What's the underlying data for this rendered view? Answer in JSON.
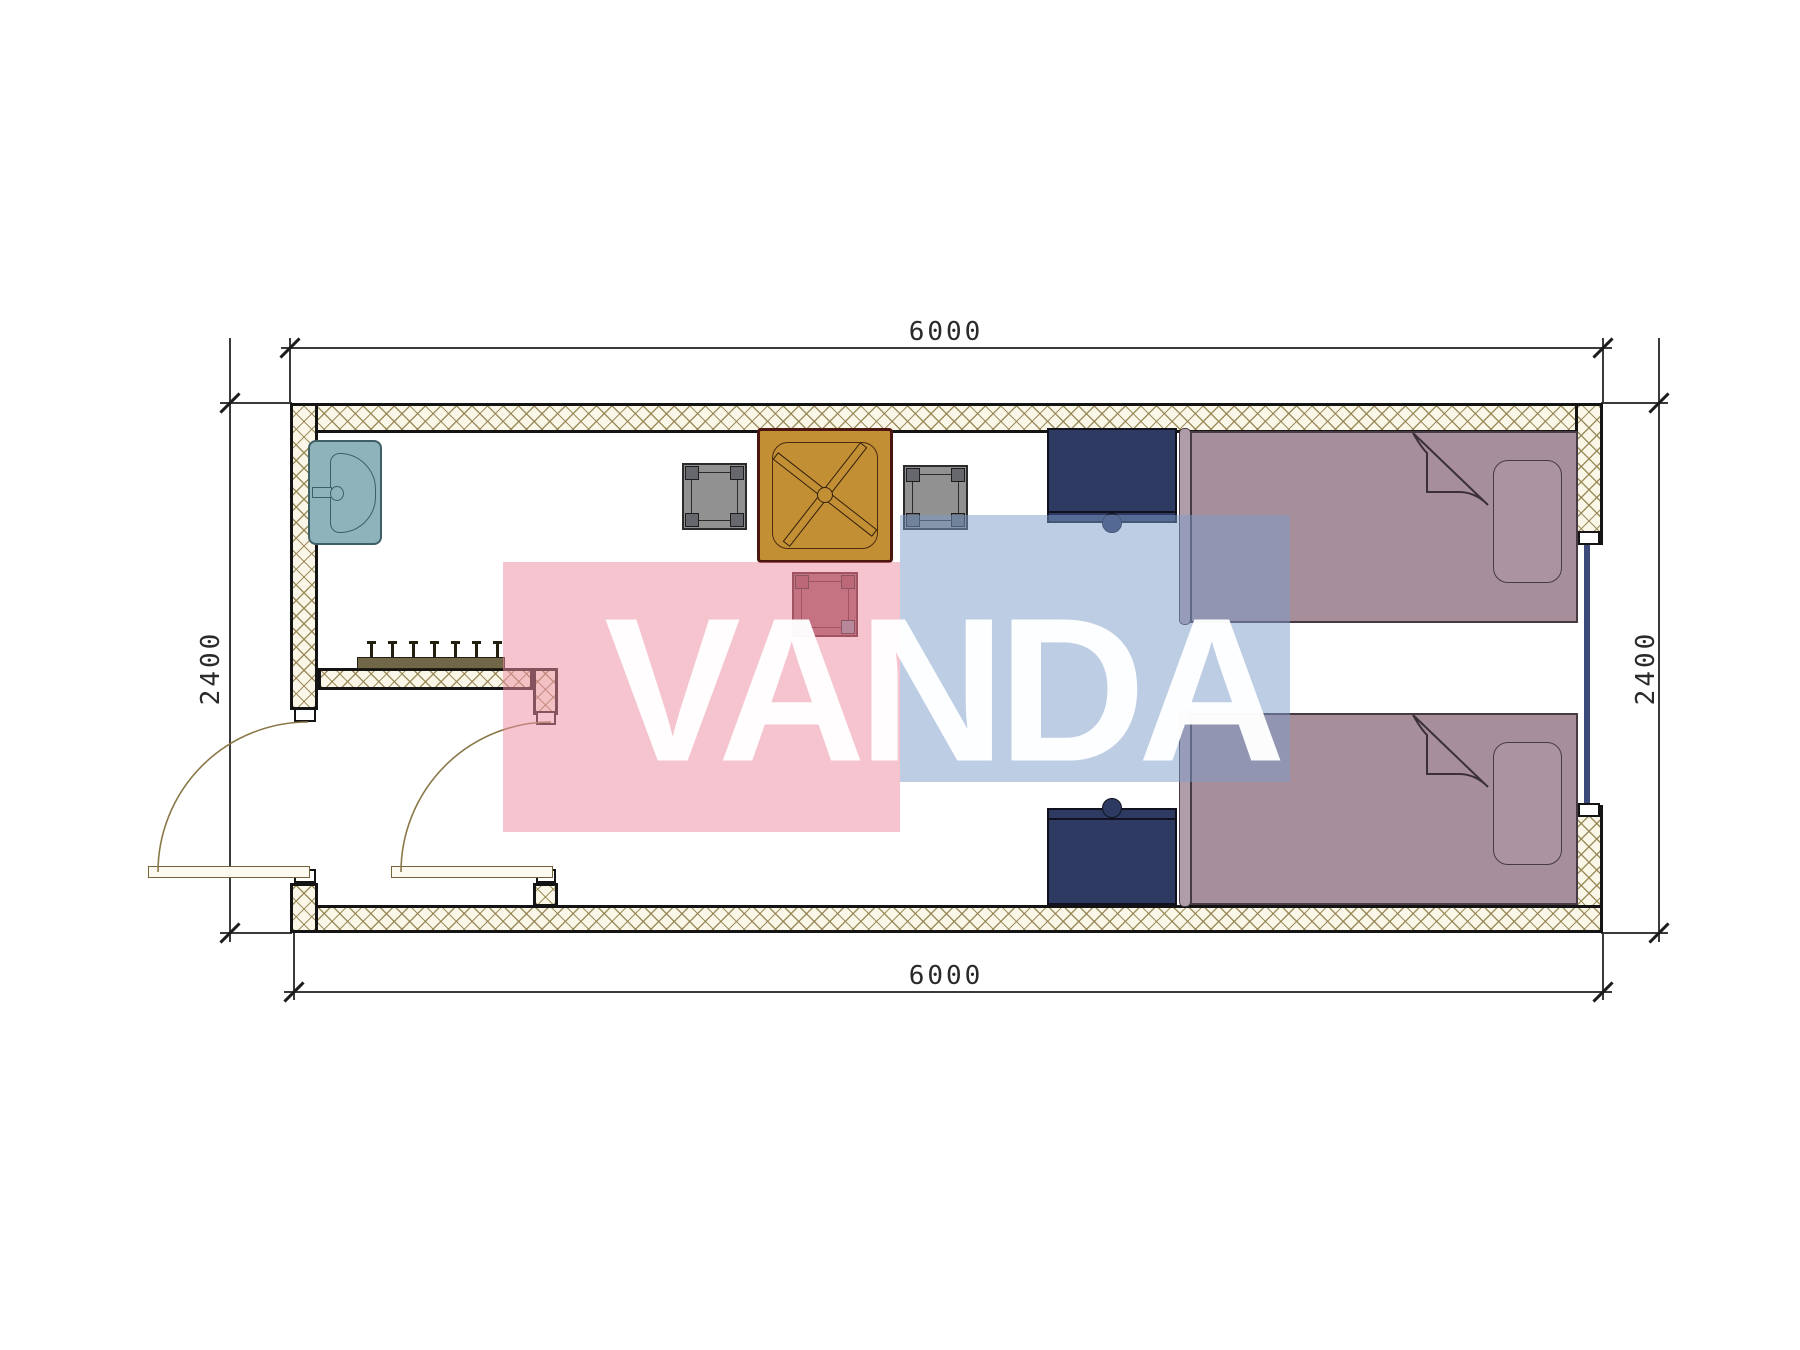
{
  "plan": {
    "type": "architectural floor plan",
    "unit": "mm",
    "room_width_mm": 6000,
    "room_depth_mm": 2400
  },
  "dimensions": {
    "top": "6000",
    "bottom": "6000",
    "left": "2400",
    "right": "2400"
  },
  "watermark": {
    "text": "VANDA",
    "pink_block": "#f3c5d0",
    "blue_block": "#c2d1e5"
  },
  "furniture": {
    "sink": "wash basin with faucet",
    "coat_rack": "wall rack with 7 hooks",
    "table": "square table with crossed legs",
    "stool_left": "stool",
    "stool_right": "stool",
    "stool_bottom": "stool",
    "nightstand_top": "nightstand with knob",
    "nightstand_bottom": "nightstand with knob",
    "bed_top": "single bed with folded blanket and pillow",
    "bed_bottom": "single bed with folded blanket and pillow",
    "door_entry": "entry swing door",
    "door_vestibule": "vestibule swing door",
    "window_right": "window in right wall"
  },
  "colors": {
    "wall_fill": "#faf6e8",
    "wall_hatch_line": "#94845a",
    "wall_border": "#141414",
    "sink": "#8fb3bb",
    "table": "#c28f35",
    "table_border": "#4d1510",
    "stool_gray": "#919191",
    "stool_red": "#9c5560",
    "nightstand": "#2e3a62",
    "bed": "#a68e9a",
    "pillow": "#ab93a0",
    "window_glass": "#3b4a78",
    "door_arc": "#8a7848"
  }
}
